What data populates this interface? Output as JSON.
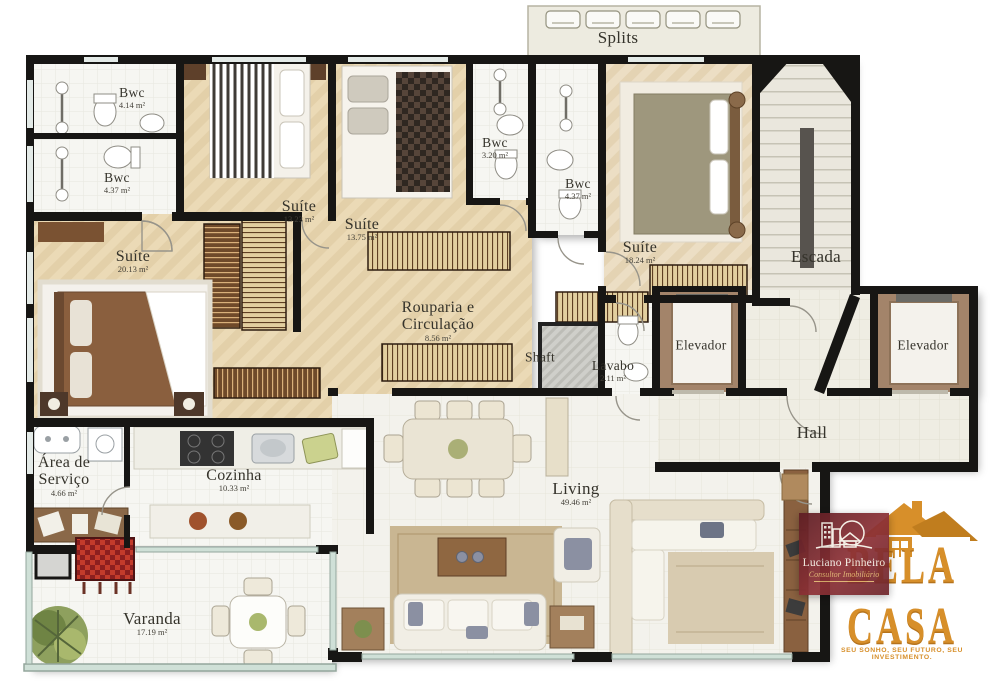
{
  "plan": {
    "title": "Apartment floor plan",
    "rooms": [
      {
        "name": "Bwc",
        "area": "4.14 m²"
      },
      {
        "name": "Bwc",
        "area": "4.37 m²"
      },
      {
        "name": "Suíte",
        "area": "13.23 m²"
      },
      {
        "name": "Suíte",
        "area": "13.75 m²"
      },
      {
        "name": "Bwc",
        "area": "3.20 m²"
      },
      {
        "name": "Bwc",
        "area": "4.37 m²"
      },
      {
        "name": "Splits",
        "area": ""
      },
      {
        "name": "Suíte",
        "area": "18.24 m²"
      },
      {
        "name": "Escada",
        "area": ""
      },
      {
        "name": "Suíte",
        "area": "20.13 m²"
      },
      {
        "name_lines": [
          "Rouparia e",
          "Circulação"
        ],
        "area": "8.56 m²"
      },
      {
        "name": "Shaft",
        "area": ""
      },
      {
        "name": "Lavabo",
        "area": "2.11 m²"
      },
      {
        "name": "Elevador",
        "area": ""
      },
      {
        "name": "Elevador",
        "area": ""
      },
      {
        "name": "Hall",
        "area": ""
      },
      {
        "name_lines": [
          "Área de",
          "Serviço"
        ],
        "area": "4.66 m²"
      },
      {
        "name": "Cozinha",
        "area": "10.33 m²"
      },
      {
        "name": "Living",
        "area": "49.46 m²"
      },
      {
        "name": "Varanda",
        "area": "17.19 m²"
      }
    ],
    "colors": {
      "wall": "#171614",
      "wood_floor": "#ead9b6",
      "tile_floor": "#f5f5f1",
      "glass": "#c3d2c9",
      "wardrobe_dark": "#6f4a2a",
      "wardrobe_light": "#e2cf9f",
      "gold": "#d78f2a",
      "logo_red": "#6e262c"
    }
  },
  "branding": {
    "luciano": {
      "name": "Luciano Pinheiro",
      "subtitle": "Consultor Imobiliário"
    },
    "bela_casa": {
      "name": "BELA CASA",
      "tagline": "SEU SONHO, SEU FUTURO, SEU INVESTIMENTO."
    }
  }
}
